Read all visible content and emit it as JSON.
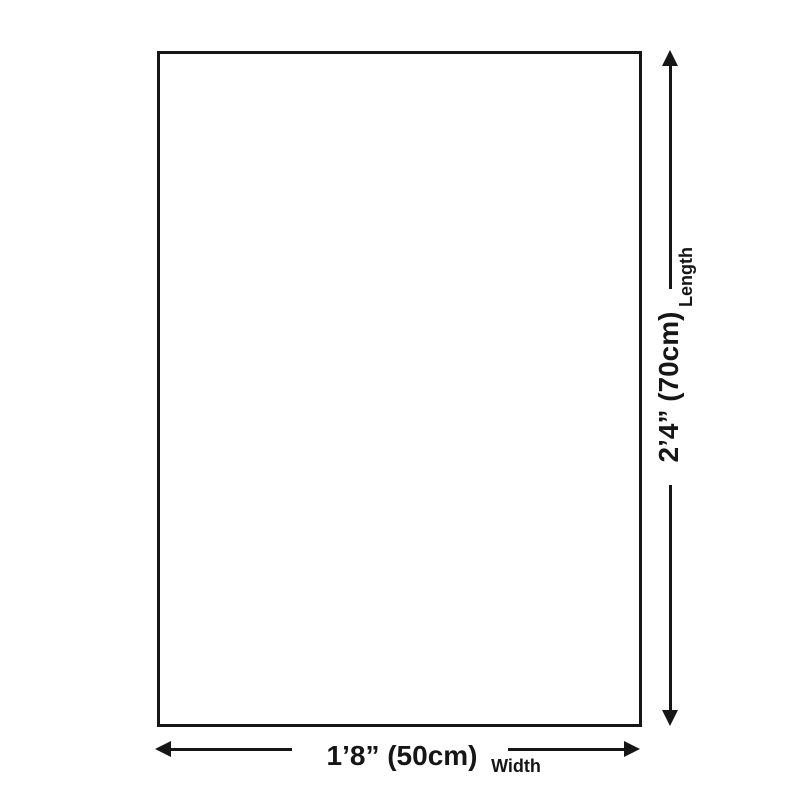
{
  "colors": {
    "background": "#ffffff",
    "ink": "#161616"
  },
  "diagram": {
    "kind": "product-size-diagram",
    "width_dim": {
      "value": "1’8” (50cm)",
      "label": "Width"
    },
    "length_dim": {
      "value": "2’4” (70cm)",
      "label": "Length"
    }
  }
}
